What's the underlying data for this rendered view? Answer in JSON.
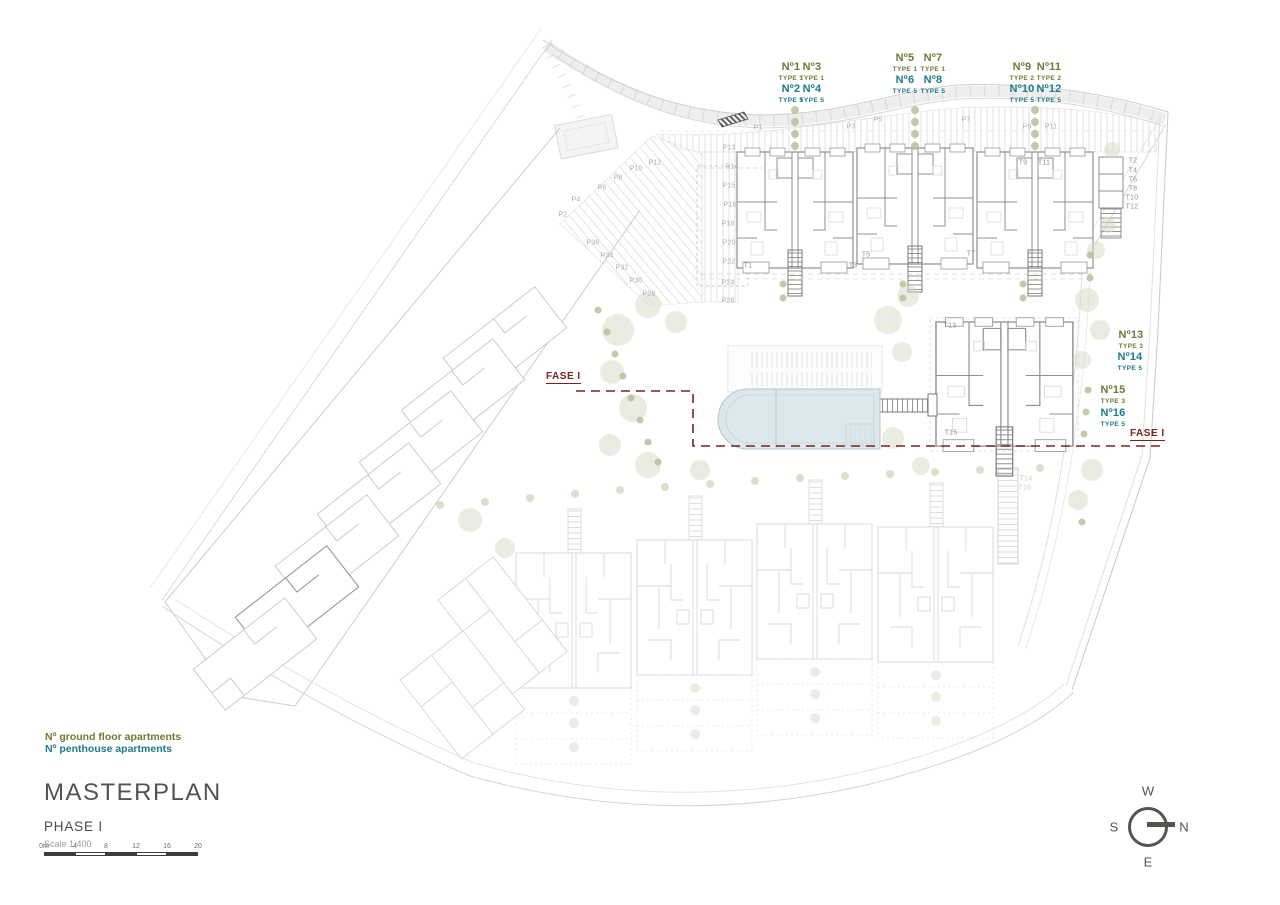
{
  "title_block": {
    "title": "MASTERPLAN",
    "phase": "PHASE I",
    "scale": "Scale 1:400"
  },
  "legend": {
    "ground": "Nº ground floor apartments",
    "penthouse": "Nº penthouse apartments"
  },
  "compass": {
    "n": "N",
    "s": "S",
    "e": "E",
    "w": "W"
  },
  "scale_bar": {
    "unit_labels": [
      "0m",
      "4",
      "8",
      "12",
      "16",
      "20"
    ]
  },
  "phase_boundary": {
    "left": "FASE I",
    "right": "FASE I"
  },
  "colors": {
    "ground_label": "#6b7b35",
    "penthouse_label": "#1e7a8c",
    "phase_line": "#7b241c",
    "title": "#55534f"
  },
  "apartment_labels": [
    {
      "n": "Nº1",
      "type": "TYPE 1",
      "cls": "ground",
      "x": 791,
      "y": 61
    },
    {
      "n": "Nº3",
      "type": "TYPE 1",
      "cls": "ground",
      "x": 812,
      "y": 61
    },
    {
      "n": "Nº2",
      "type": "TYPE 5",
      "cls": "pent",
      "x": 791,
      "y": 83
    },
    {
      "n": "Nº4",
      "type": "TYPE 5",
      "cls": "pent",
      "x": 812,
      "y": 83
    },
    {
      "n": "Nº5",
      "type": "TYPE 1",
      "cls": "ground",
      "x": 905,
      "y": 52
    },
    {
      "n": "Nº7",
      "type": "TYPE 1",
      "cls": "ground",
      "x": 933,
      "y": 52
    },
    {
      "n": "Nº6",
      "type": "TYPE 5",
      "cls": "pent",
      "x": 905,
      "y": 74
    },
    {
      "n": "Nº8",
      "type": "TYPE 5",
      "cls": "pent",
      "x": 933,
      "y": 74
    },
    {
      "n": "Nº9",
      "type": "TYPE 2",
      "cls": "ground",
      "x": 1022,
      "y": 61
    },
    {
      "n": "Nº11",
      "type": "TYPE 2",
      "cls": "ground",
      "x": 1049,
      "y": 61
    },
    {
      "n": "Nº10",
      "type": "TYPE 5",
      "cls": "pent",
      "x": 1022,
      "y": 83
    },
    {
      "n": "Nº12",
      "type": "TYPE 5",
      "cls": "pent",
      "x": 1049,
      "y": 83
    },
    {
      "n": "Nº13",
      "type": "TYPE 3",
      "cls": "ground",
      "x": 1131,
      "y": 329
    },
    {
      "n": "Nº14",
      "type": "TYPE 5",
      "cls": "pent",
      "x": 1130,
      "y": 351
    },
    {
      "n": "Nº15",
      "type": "TYPE 3",
      "cls": "ground",
      "x": 1113,
      "y": 384
    },
    {
      "n": "Nº16",
      "type": "TYPE 5",
      "cls": "pent",
      "x": 1113,
      "y": 407
    }
  ],
  "parking_labels": [
    {
      "t": "P1",
      "x": 758,
      "y": 128
    },
    {
      "t": "P3",
      "x": 851,
      "y": 127
    },
    {
      "t": "P5",
      "x": 878,
      "y": 120
    },
    {
      "t": "P7",
      "x": 966,
      "y": 120
    },
    {
      "t": "P9",
      "x": 1027,
      "y": 127
    },
    {
      "t": "P11",
      "x": 1051,
      "y": 127
    },
    {
      "t": "P13",
      "x": 729,
      "y": 148
    },
    {
      "t": "R14",
      "x": 732,
      "y": 167
    },
    {
      "t": "P15",
      "x": 729,
      "y": 186
    },
    {
      "t": "P16",
      "x": 730,
      "y": 205
    },
    {
      "t": "P18",
      "x": 728,
      "y": 224
    },
    {
      "t": "P20",
      "x": 729,
      "y": 243
    },
    {
      "t": "P22",
      "x": 729,
      "y": 262
    },
    {
      "t": "P24",
      "x": 728,
      "y": 283
    },
    {
      "t": "P26",
      "x": 728,
      "y": 301
    },
    {
      "t": "P2",
      "x": 563,
      "y": 215
    },
    {
      "t": "P4",
      "x": 576,
      "y": 200
    },
    {
      "t": "P6",
      "x": 602,
      "y": 188
    },
    {
      "t": "P8",
      "x": 618,
      "y": 178
    },
    {
      "t": "P10",
      "x": 636,
      "y": 169
    },
    {
      "t": "P12",
      "x": 655,
      "y": 163
    },
    {
      "t": "P28",
      "x": 649,
      "y": 294
    },
    {
      "t": "P30",
      "x": 636,
      "y": 281
    },
    {
      "t": "P32",
      "x": 622,
      "y": 268
    },
    {
      "t": "P34",
      "x": 607,
      "y": 256
    },
    {
      "t": "P36",
      "x": 593,
      "y": 243
    }
  ],
  "stair_labels": [
    {
      "t": "T1",
      "x": 748,
      "y": 266,
      "faint": false
    },
    {
      "t": "T3",
      "x": 853,
      "y": 266,
      "faint": false
    },
    {
      "t": "T5",
      "x": 866,
      "y": 255,
      "faint": false
    },
    {
      "t": "T7",
      "x": 971,
      "y": 254,
      "faint": false
    },
    {
      "t": "T9",
      "x": 1023,
      "y": 163,
      "faint": false
    },
    {
      "t": "T11",
      "x": 1044,
      "y": 163,
      "faint": false
    },
    {
      "t": "T2",
      "x": 1133,
      "y": 161,
      "faint": false
    },
    {
      "t": "T4",
      "x": 1133,
      "y": 171,
      "faint": false
    },
    {
      "t": "T6",
      "x": 1133,
      "y": 180,
      "faint": false
    },
    {
      "t": "T8",
      "x": 1133,
      "y": 189,
      "faint": false
    },
    {
      "t": "T10",
      "x": 1132,
      "y": 198,
      "faint": false
    },
    {
      "t": "T12",
      "x": 1132,
      "y": 207,
      "faint": false
    },
    {
      "t": "T13",
      "x": 950,
      "y": 326,
      "faint": false
    },
    {
      "t": "T15",
      "x": 951,
      "y": 433,
      "faint": false
    },
    {
      "t": "T14",
      "x": 1026,
      "y": 479,
      "faint": true
    },
    {
      "t": "T16",
      "x": 1025,
      "y": 488,
      "faint": true
    }
  ]
}
